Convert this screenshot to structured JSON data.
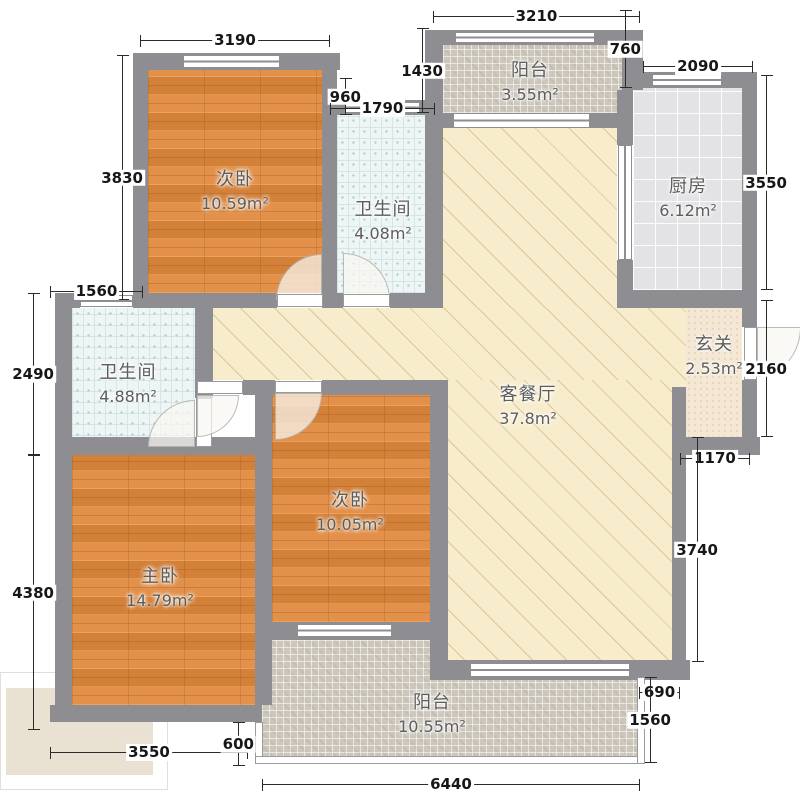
{
  "plan": {
    "title": "3室2厅户型图",
    "rooms": {
      "bedroom_top": {
        "name": "次卧",
        "area": "10.59m²"
      },
      "bath_top": {
        "name": "卫生间",
        "area": "4.08m²"
      },
      "balcony_top": {
        "name": "阳台",
        "area": "3.55m²"
      },
      "kitchen": {
        "name": "厨房",
        "area": "6.12m²"
      },
      "living": {
        "name": "客餐厅",
        "area": "37.8m²"
      },
      "entry": {
        "name": "玄关",
        "area": "2.53m²"
      },
      "bath_left": {
        "name": "卫生间",
        "area": "4.88m²"
      },
      "master": {
        "name": "主卧",
        "area": "14.79m²"
      },
      "bedroom_right": {
        "name": "次卧",
        "area": "10.05m²"
      },
      "balcony_bottom": {
        "name": "阳台",
        "area": "10.55m²"
      }
    },
    "dimensions": {
      "top_balcony_width": "3210",
      "bedroom_top_width": "3190",
      "balcony_top_depth": "1430",
      "wall_gap": "960",
      "bath_top_window": "1790",
      "kitchen_gap": "760",
      "kitchen_width": "2090",
      "kitchen_right_height": "3550",
      "bedroom_top_height": "3830",
      "bath_left_window": "1560",
      "bath_left_height": "2490",
      "master_left_height": "4380",
      "entry_right_height": "2160",
      "entry_bottom_width": "1170",
      "living_right_height": "3740",
      "balcony_step": "690",
      "balcony_right_height": "1560",
      "bottom_balcony_width": "6440",
      "master_bottom_width": "3550",
      "step_height": "600"
    },
    "colors": {
      "wall": "#8e8e92",
      "wood_floor": "#e0883c",
      "living_floor": "#f7edcd",
      "bath_floor": "#eef5f5",
      "balcony_floor": "#cdc7bb",
      "kitchen_floor": "#e3e3e6",
      "entry_floor": "#f4e7d3",
      "dimension_text": "#171717",
      "room_label_text": "#5d5d5d"
    }
  }
}
